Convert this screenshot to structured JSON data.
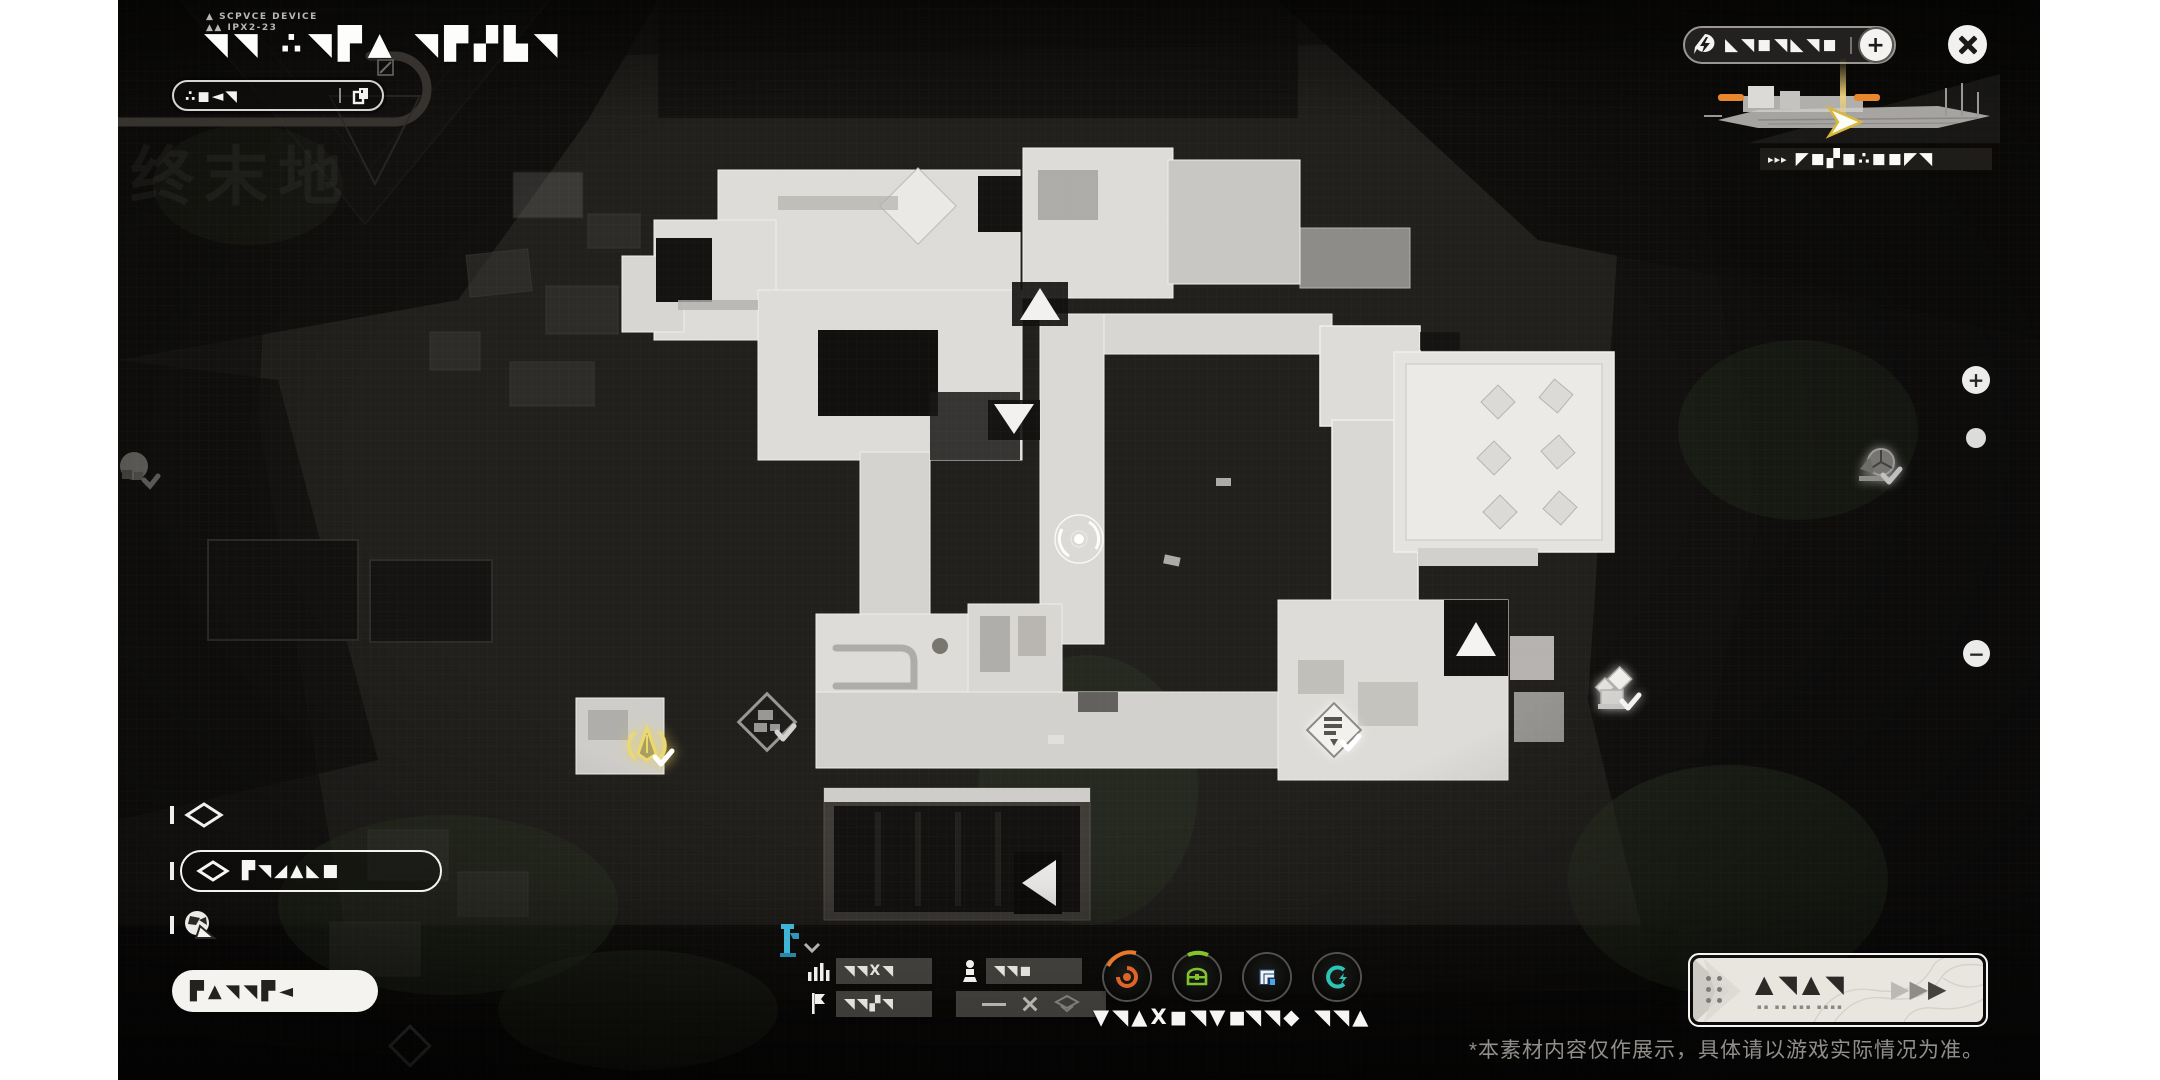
{
  "header": {
    "device_caption_line1": "SCPVCE DEVICE",
    "device_caption_line2": "IPX2-23",
    "title_glyphs": "◥◥ ∴◥▛▲ ◥▛▞▙◥",
    "watermark": "终末地",
    "tracker_pill_glyphs": "∴◼◄◥"
  },
  "top_right": {
    "resource_pill_glyphs": "◣◥◼◥◣◥◼",
    "add_button": "+",
    "ship_arrows": "▸▸▸",
    "ship_label_glyphs": "◤◼▞◼∴◼◼◤◥"
  },
  "zoom_controls": {
    "zoom_in": "+",
    "zoom_out": "−"
  },
  "legend": {
    "selected_glyphs": "▛◥◢▲◣■",
    "bottom_pill_glyphs": "▛▲◥◥▛◄"
  },
  "filters": {
    "row1_left_glyphs": "◥◥X◥",
    "row1_right_glyphs": "◥◥◼",
    "row2_left_glyphs": "◥◥▞◥"
  },
  "resources": {
    "caption_main": "▼◥▲X◼◥▼◼",
    "caption_mid": "◥◥◆",
    "caption_right": "◥◥▲"
  },
  "cta": {
    "glyphs": "▲◥▲◥",
    "subtext": "▪▪ ▪▪ ▪▪▪ ▪▪▪▪",
    "arrow": "▶"
  },
  "colors": {
    "accent_yellow": "#ecd96e",
    "accent_orange": "#e06428",
    "accent_green": "#7dc42e",
    "accent_blue": "#4aa4e8",
    "accent_teal": "#2cc4b4"
  },
  "window": {
    "disclaimer": "*本素材内容仅作展示，具体请以游戏实际情况为准。"
  }
}
